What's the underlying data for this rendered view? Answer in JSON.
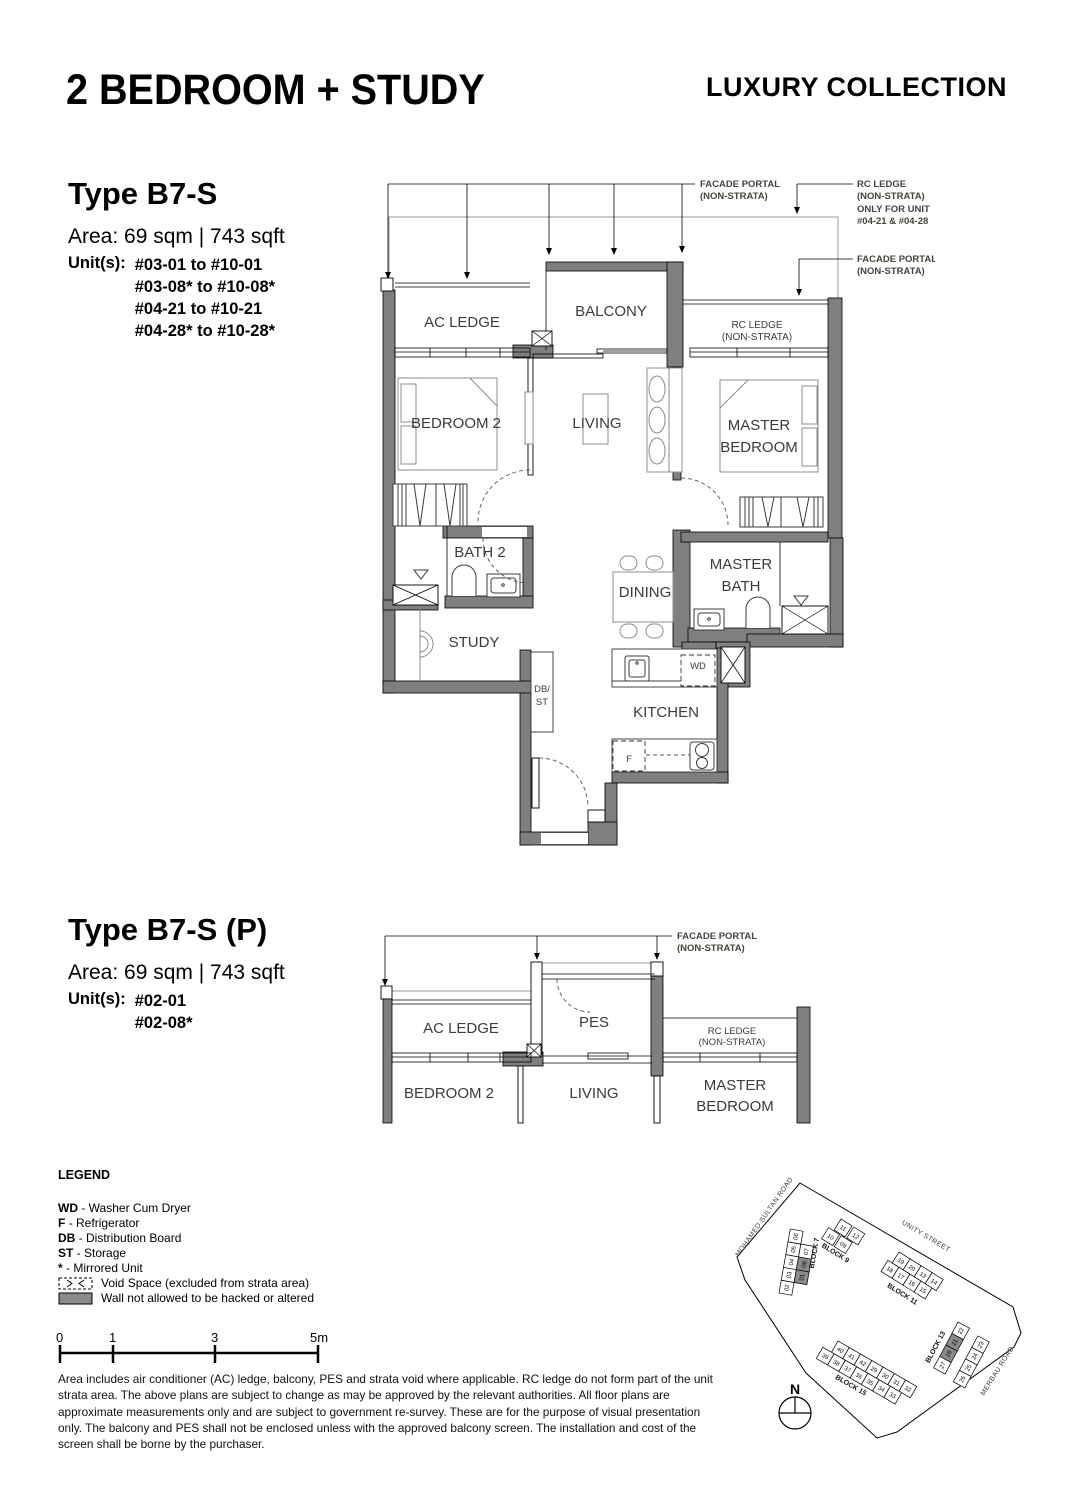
{
  "header": {
    "title": "2 BEDROOM + STUDY",
    "collection": "LUXURY COLLECTION"
  },
  "plan1": {
    "type_name": "Type B7-S",
    "area_label": "Area: 69 sqm | 743 sqft",
    "units_label": "Unit(s):",
    "units": [
      "#03-01 to #10-01",
      "#03-08* to #10-08*",
      "#04-21 to #10-21",
      "#04-28* to #10-28*"
    ],
    "labels": {
      "ac_ledge": "AC LEDGE",
      "balcony": "BALCONY",
      "rc_ledge_1": "RC LEDGE",
      "rc_ledge_2": "(NON-STRATA)",
      "bedroom2": "BEDROOM 2",
      "living": "LIVING",
      "master_1": "MASTER",
      "master_2": "BEDROOM",
      "bath2": "BATH 2",
      "dining": "DINING",
      "master_bath_1": "MASTER",
      "master_bath_2": "BATH",
      "study": "STUDY",
      "db_1": "DB/",
      "db_2": "ST",
      "wd": "WD",
      "kitchen": "KITCHEN",
      "fridge": "F"
    },
    "callouts": {
      "facade_portal_1": "FACADE PORTAL",
      "facade_portal_2": "(NON-STRATA)",
      "rc_ledge_1": "RC LEDGE",
      "rc_ledge_2": "(NON-STRATA)",
      "rc_ledge_3": "ONLY FOR UNIT",
      "rc_ledge_4": "#04-21 & #04-28",
      "facade_portal_b1": "FACADE PORTAL",
      "facade_portal_b2": "(NON-STRATA)"
    }
  },
  "plan2": {
    "type_name": "Type B7-S (P)",
    "area_label": "Area: 69 sqm | 743 sqft",
    "units_label": "Unit(s):",
    "units": [
      "#02-01",
      "#02-08*"
    ],
    "labels": {
      "ac_ledge": "AC LEDGE",
      "pes": "PES",
      "rc_ledge_1": "RC LEDGE",
      "rc_ledge_2": "(NON-STRATA)",
      "bedroom2": "BEDROOM 2",
      "living": "LIVING",
      "master_1": "MASTER",
      "master_2": "BEDROOM"
    },
    "callouts": {
      "facade_portal_1": "FACADE PORTAL",
      "facade_portal_2": "(NON-STRATA)"
    }
  },
  "legend": {
    "heading": "LEGEND",
    "items": [
      {
        "term": "WD",
        "desc": "- Washer Cum Dryer"
      },
      {
        "term": "F",
        "desc": "- Refrigerator"
      },
      {
        "term": "DB",
        "desc": "- Distribution Board"
      },
      {
        "term": "ST",
        "desc": "- Storage"
      },
      {
        "term": "*",
        "desc": "- Mirrored Unit"
      }
    ],
    "void_label": "Void Space (excluded from strata area)",
    "wall_label": "Wall not allowed to be hacked or altered"
  },
  "scale": {
    "ticks": [
      "0",
      "1",
      "3",
      "5m"
    ]
  },
  "disclaimer": "Area includes air conditioner (AC) ledge, balcony, PES and strata void where applicable. RC ledge do not form part of the unit strata area. The above plans are subject to change as may be approved by the relevant authorities. All floor plans are approximate measurements only and are subject to government re-survey. These are for the purpose of visual presentation only. The balcony and PES shall not be enclosed unless with the approved balcony screen. The installation and cost of the screen shall be borne by the purchaser.",
  "map": {
    "north_label": "N",
    "roads": [
      "MOHAMED SULTAN ROAD",
      "UNITY STREET",
      "MERBAU ROAD"
    ],
    "colors": {
      "highlight": "#8a8a8a"
    },
    "blocks": [
      {
        "name": "BLOCK 7",
        "origin": [
          779,
          1293
        ],
        "angle": -80,
        "step": 13,
        "label_pos": [
          30,
          30
        ],
        "highlighted": [
          "01",
          "08"
        ],
        "rows": [
          {
            "offset": [
              0,
              0
            ],
            "units": [
              "02",
              "03",
              "04",
              "05",
              "06"
            ]
          },
          {
            "offset": [
              13,
              13
            ],
            "units": [
              "01",
              "08",
              "07"
            ]
          }
        ]
      },
      {
        "name": "BLOCK 9",
        "origin": [
          841,
          1219
        ],
        "angle": 32,
        "step": 15,
        "label_pos": [
          -2,
          34
        ],
        "highlighted": [],
        "rows": [
          {
            "offset": [
              0,
              0
            ],
            "units": [
              "11",
              "12"
            ]
          },
          {
            "offset": [
              -6,
              14
            ],
            "units": [
              "10",
              "09"
            ]
          }
        ]
      },
      {
        "name": "BLOCK 11",
        "origin": [
          899,
          1252
        ],
        "angle": 32,
        "step": 13,
        "label_pos": [
          8,
          36
        ],
        "highlighted": [],
        "rows": [
          {
            "offset": [
              0,
              0
            ],
            "units": [
              "19",
              "20",
              "13",
              "14"
            ]
          },
          {
            "offset": [
              -5,
              13
            ],
            "units": [
              "18",
              "17",
              "16",
              "15"
            ]
          }
        ]
      },
      {
        "name": "BLOCK 13",
        "origin": [
          958,
          1322
        ],
        "angle": -62,
        "step": -13,
        "label_pos": [
          -50,
          -6
        ],
        "highlighted": [
          "21",
          "28"
        ],
        "rows": [
          {
            "offset": [
              0,
              0
            ],
            "units": [
              "22",
              "21",
              "28",
              "27"
            ]
          },
          {
            "offset": [
              -3,
              24
            ],
            "units": [
              "23",
              "24",
              "25",
              "26"
            ]
          }
        ]
      },
      {
        "name": "BLOCK 15",
        "origin": [
          838,
          1341
        ],
        "angle": 30,
        "step": 13,
        "label_pos": [
          16,
          34
        ],
        "highlighted": [],
        "rows": [
          {
            "offset": [
              0,
              0
            ],
            "units": [
              "40",
              "41",
              "42",
              "29",
              "30",
              "31",
              "32"
            ]
          },
          {
            "offset": [
              -10,
              13
            ],
            "units": [
              "39",
              "38",
              "37",
              "36",
              "35",
              "34",
              "33"
            ]
          }
        ]
      }
    ]
  }
}
